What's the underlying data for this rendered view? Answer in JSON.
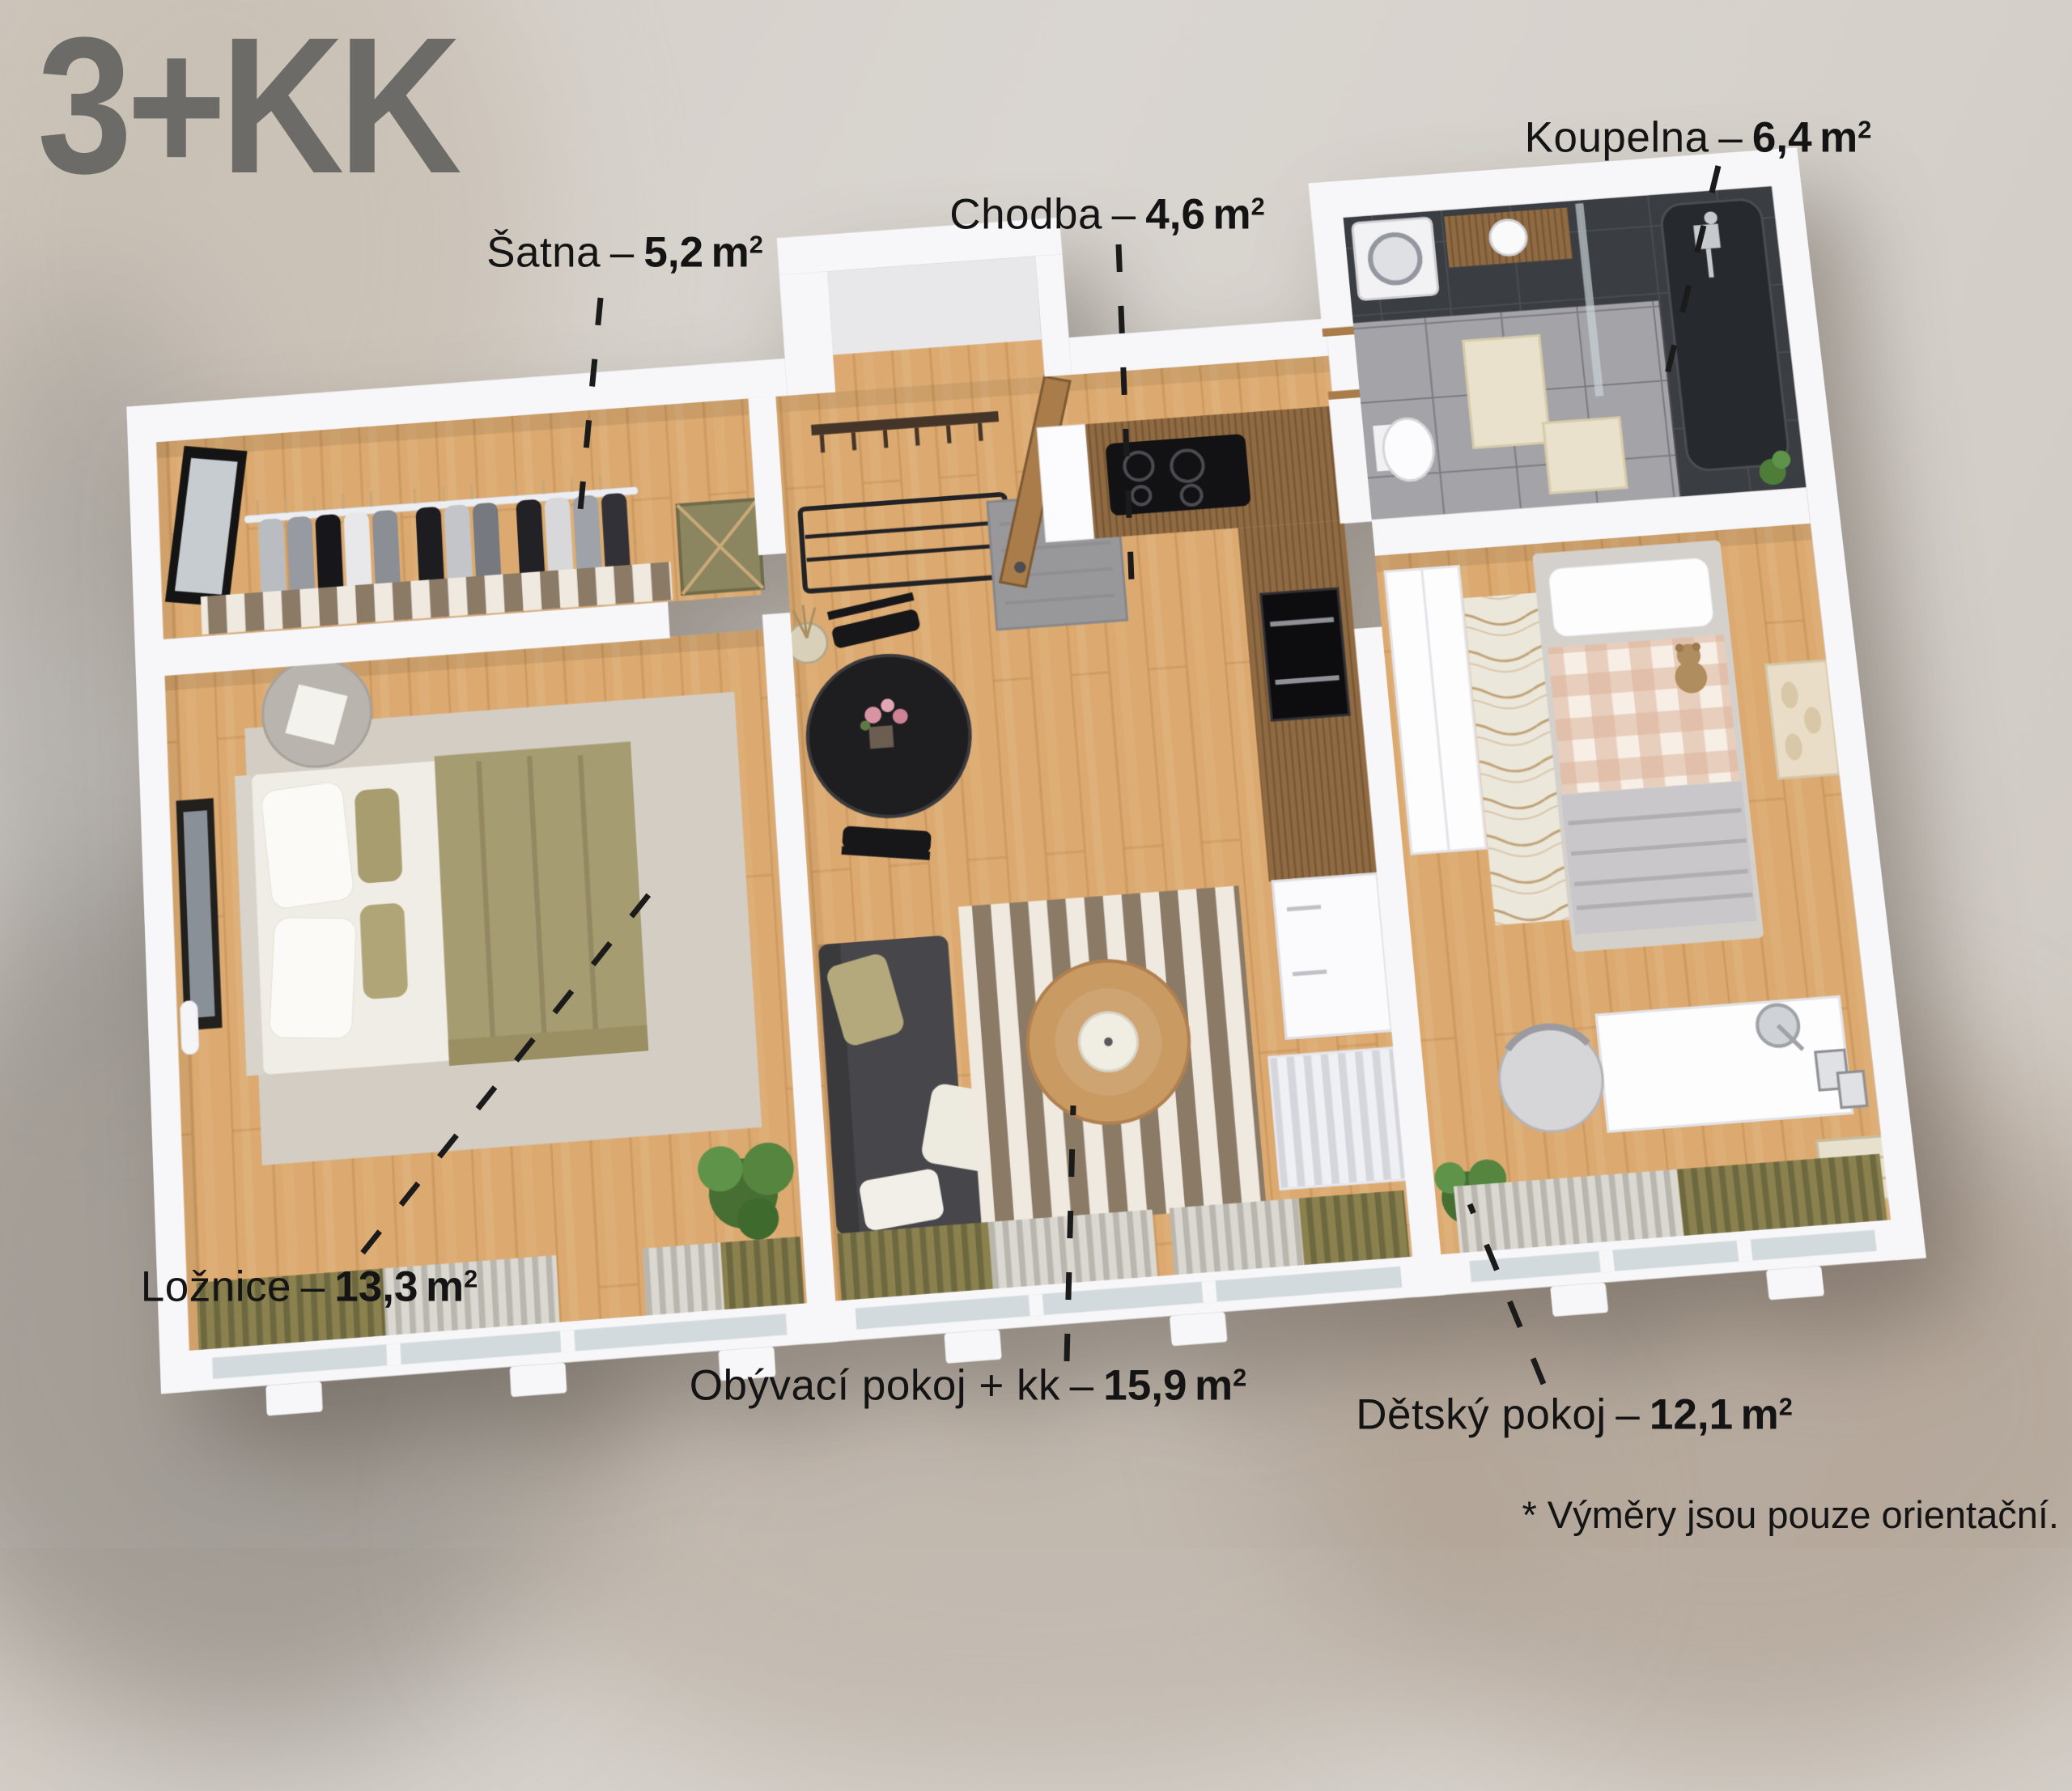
{
  "title": {
    "text": "3+KK"
  },
  "rooms": [
    {
      "id": "satna",
      "name": "Šatna",
      "area_m2": "5,2"
    },
    {
      "id": "chodba",
      "name": "Chodba",
      "area_m2": "4,6"
    },
    {
      "id": "koupelna",
      "name": "Koupelna",
      "area_m2": "6,4"
    },
    {
      "id": "loznice",
      "name": "Ložnice",
      "area_m2": "13,3"
    },
    {
      "id": "obyvaci",
      "name": "Obývací pokoj + kk",
      "area_m2": "15,9"
    },
    {
      "id": "detsky",
      "name": "Dětský pokoj",
      "area_m2": "12,1"
    }
  ],
  "label_format": {
    "separator": "–",
    "unit": "m",
    "unit_sup": "2"
  },
  "footnote": {
    "text": "* Výměry jsou pouze orientační."
  },
  "palette": {
    "title_color": "#6c6b68",
    "text_color": "#141414",
    "leader_color": "#1b1b1b",
    "wall_white": "#f7f7f9",
    "floor_wood": "#dcaa70",
    "wood_seam": "#bf8c52",
    "counter_walnut": "#8f6a42",
    "bath_tile": "#a4a3a8",
    "bath_dark": "#3a3d42",
    "sofa_dark": "#47474b",
    "rug_brown": "#8a7a66",
    "rug_cream": "#efe9df",
    "bedroom_rug": "#d3cdc4",
    "blanket_olive": "#a69c72",
    "curtain_olive": "#8a814f",
    "curtain_light": "#dbd8d1",
    "kids_rug": "#ece7db",
    "gingham_pink": "#dcb39a",
    "plant_green": "#4e7d3a",
    "door_wood": "#a97c4a",
    "glass": "#d3dade",
    "radiator": "#e6e6ec"
  }
}
